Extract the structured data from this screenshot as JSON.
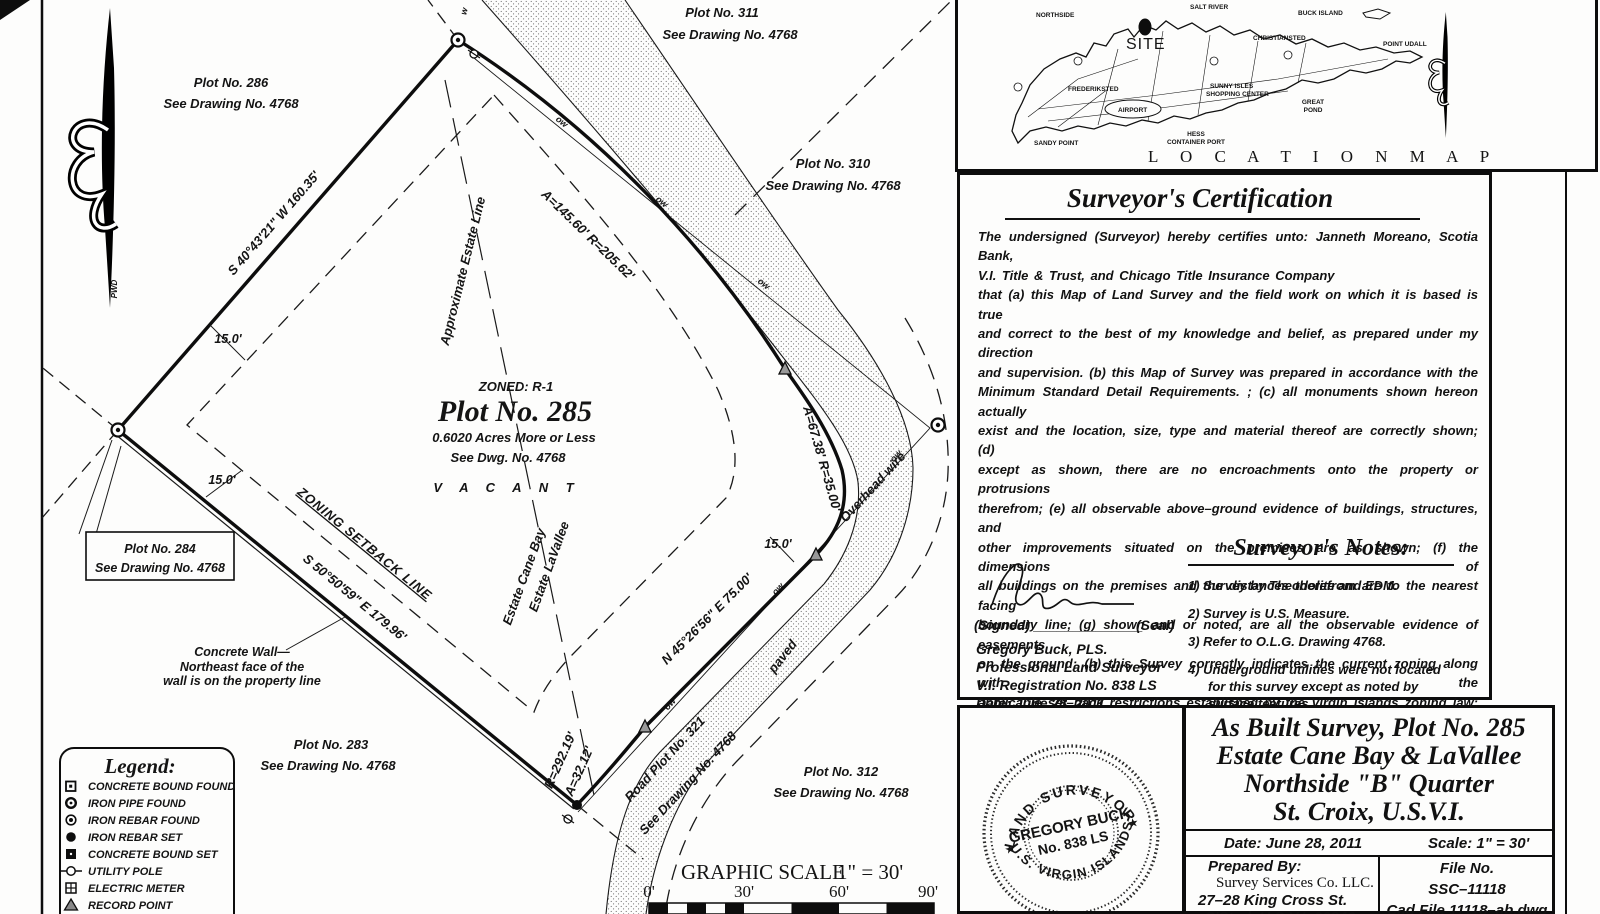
{
  "plat": {
    "plots": {
      "p286": {
        "name": "Plot No. 286",
        "ref": "See Drawing No. 4768"
      },
      "p311": {
        "name": "Plot No. 311",
        "ref": "See Drawing No. 4768"
      },
      "p310": {
        "name": "Plot No. 310",
        "ref": "See Drawing No. 4768"
      },
      "p284": {
        "name": "Plot No. 284",
        "ref": "See Drawing No. 4768"
      },
      "p283": {
        "name": "Plot No. 283",
        "ref": "See Drawing No. 4768"
      },
      "p312": {
        "name": "Plot No. 312",
        "ref": "See Drawing No. 4768"
      }
    },
    "parcel": {
      "zoning": "ZONED: R-1",
      "title": "Plot No. 285",
      "area": "0.6020 Acres More or Less",
      "see": "See Dwg. No. 4768",
      "status": "V A C A N T"
    },
    "bearings": {
      "nw": "S 40°43'21\" W  160.35'",
      "curve_main": "A=145.60'  R=205.62'",
      "curve_bend": "A=67.38'  R=35.00'",
      "ne": "N 45°26'56\" E  75.00'",
      "curve_low_r": "R=292.19'",
      "curve_low_a": "A=32.12'",
      "sw": "S 50°50'59\" E  179.96'"
    },
    "labels": {
      "estate_line": "Approximate Estate Line",
      "estate_w": "Estate LaVallee",
      "estate_e": "Estate Cane Bay",
      "setback": "ZONING SETBACK LINE",
      "overhead": "Overhead wire",
      "paved": "paved",
      "road": "Road Plot No. 321",
      "road_ref": "See Drawing No. 4768",
      "wall1": "Concrete Wall—",
      "wall2": "Northeast face of the",
      "wall3": "wall is on the property line",
      "d15": "15.0'",
      "ow": "ow",
      "w": "w",
      "pwd": "PWD"
    },
    "legend": {
      "title": "Legend:",
      "items": [
        {
          "symbol": "concrete-bound-found",
          "label": "CONCRETE BOUND FOUND"
        },
        {
          "symbol": "iron-pipe-found",
          "label": "IRON PIPE FOUND"
        },
        {
          "symbol": "iron-rebar-found",
          "label": "IRON REBAR FOUND"
        },
        {
          "symbol": "iron-rebar-set",
          "label": "IRON REBAR SET"
        },
        {
          "symbol": "concrete-bound-set",
          "label": "CONCRETE BOUND SET"
        },
        {
          "symbol": "utility-pole",
          "label": "UTILITY POLE"
        },
        {
          "symbol": "electric-meter",
          "label": "ELECTRIC METER"
        },
        {
          "symbol": "record-point",
          "label": "RECORD POINT"
        }
      ]
    },
    "scale_bar": {
      "title": "GRAPHIC SCALE",
      "ratio": "1\" = 30'",
      "t0": "0'",
      "t30": "30'",
      "t60": "60'",
      "t90": "90'"
    }
  },
  "location_map": {
    "title": "L O C A T I O N   M A P",
    "site": "SITE",
    "labels": {
      "northside": "NORTHSIDE",
      "salt_river": "SALT RIVER",
      "buck_island": "BUCK ISLAND",
      "christiansted": "CHRISTIANSTED",
      "point_udall": "POINT UDALL",
      "frederiksted": "FREDERIKSTED",
      "sunny_isles": "SUNNY ISLES",
      "shopping_center": "SHOPPING CENTER",
      "airport": "AIRPORT",
      "great_pond": "GREAT",
      "great_pond2": "POND",
      "hess": "HESS",
      "hess2": "CONTAINER PORT",
      "sandy_point": "SANDY POINT"
    }
  },
  "certification": {
    "title": "Surveyor's Certification",
    "lines": [
      "The undersigned (Surveyor) hereby certifies unto: Janneth Moreano, Scotia Bank,",
      "V.I. Title & Trust, and Chicago Title Insurance Company",
      "that (a) this Map of Land Survey and the field work on which it is based is true",
      "and correct to the best of my knowledge and belief, as prepared under my direction",
      "and supervision.  (b) this Map of Survey was prepared in accordance with the",
      "Minimum Standard Detail Requirements. ; (c) all monuments shown hereon actually",
      "exist and the location, size, type and material thereof are correctly shown; (d)",
      "except as shown, there are no encroachments onto the property or protrusions",
      "therefrom; (e) all observable above–ground evidence of buildings, structures, and",
      "other improvements situated on the premises are as shown; (f) the dimensions of",
      "all buildings on the premises and the distances therefrom are to the nearest facing",
      "boundary line; (g) shown and or noted, are all the observable evidence of easements",
      "on the ground; (h) this Survey correctly indicates the current zoning along with the",
      "applicable set–back restrictions established by the Virgin Islands zoning law; (i)",
      "this Survey correctly and accurately shows the boundary lines, dimensions and areas",
      "of land indicated hereon per the recorded plan.  Any differences between the record",
      "dimensions and the dimensions shown hereon are either field measurments, or",
      "adjusted to produce a mathematically closed figure."
    ],
    "signed": "(Signed) ______________",
    "seal": "(Seal)",
    "surveyor": "Gregory Buck, PLS.",
    "role": "Professional Land Surveyor",
    "registration": "V.I. Registration No. 838 LS",
    "date": "Date: June 28, 2011"
  },
  "notes": {
    "title": "Surveyor's Notes:",
    "items": [
      "1) Survey by Theodolite and EDM.",
      "2) Survey is U.S. Measure.",
      "3) Refer to O.L.G. Drawing 4768.",
      "4) Underground utilities were not located for this survey except as noted by surface features."
    ]
  },
  "stamp": {
    "arc_top": "LAND SURVEYOR",
    "center1": "GREGORY BUCK",
    "center2": "No. 838 LS",
    "arc_bottom": "U.S. VIRGIN ISLANDS",
    "star": "★"
  },
  "title_block": {
    "line1": "As Built Survey,  Plot No. 285",
    "line2": "Estate Cane Bay & LaVallee",
    "line3": "Northside \"B\" Quarter",
    "line4": "St. Croix, U.S.V.I.",
    "date": "Date: June 28, 2011",
    "scale": "Scale: 1\" = 30'",
    "prepared_by": "Prepared By:",
    "company": "Survey Services Co. LLC.",
    "address1": "27–28 King Cross St.",
    "address2": "C'Sted, U.S.V.I. 00840",
    "file_no_label": "File No.",
    "file_no": "SSC–11118",
    "cad_file": "Cad File 11118–ab.dwg"
  }
}
